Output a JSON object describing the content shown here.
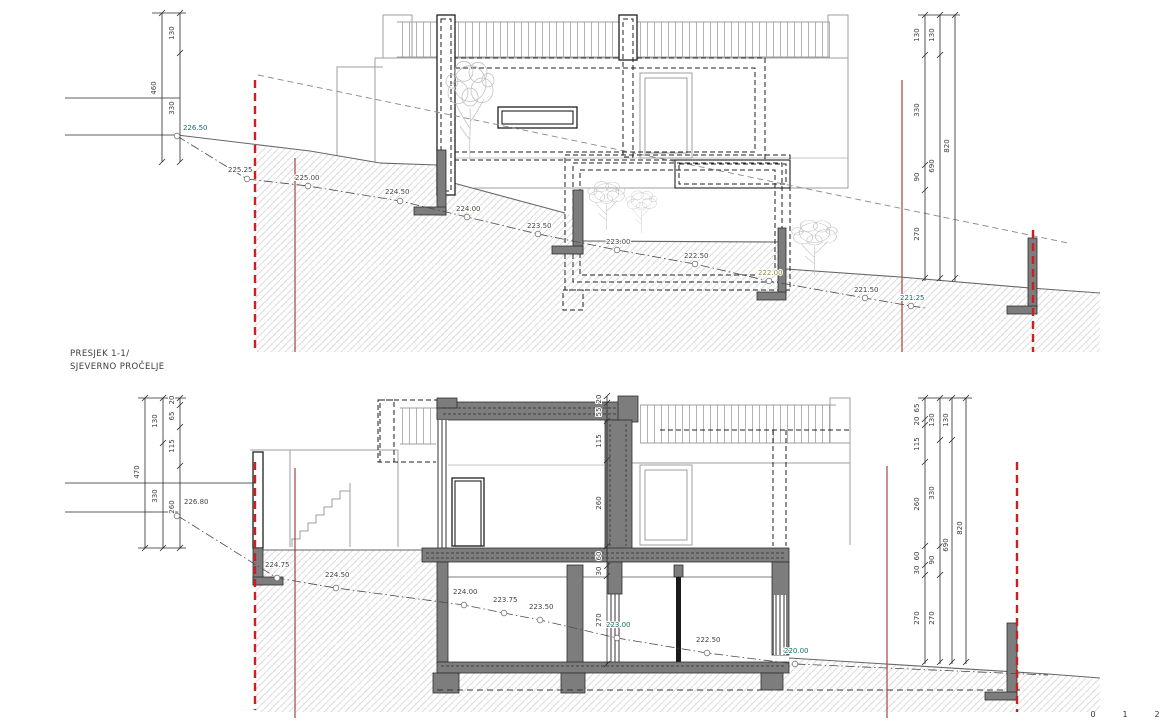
{
  "title": {
    "line1": "PRESJEK 1-1/",
    "line2": "SJEVERNO PROČELJE"
  },
  "scale": {
    "t0": "0",
    "t1": "1",
    "t2": "2"
  },
  "colors": {
    "teal": "#1b6b6b",
    "olive": "#8f8f3a",
    "spot": "#45453f",
    "dim": "#3d3d3a"
  },
  "top": {
    "dims": [
      {
        "t": "460",
        "x": 156,
        "y": 88
      },
      {
        "t": "130",
        "x": 174,
        "y": 33
      },
      {
        "t": "330",
        "x": 174,
        "y": 108
      },
      {
        "t": "130",
        "x": 919,
        "y": 35
      },
      {
        "t": "330",
        "x": 919,
        "y": 110
      },
      {
        "t": "90",
        "x": 919,
        "y": 177
      },
      {
        "t": "270",
        "x": 919,
        "y": 234
      },
      {
        "t": "130",
        "x": 934,
        "y": 35
      },
      {
        "t": "690",
        "x": 934,
        "y": 166
      },
      {
        "t": "820",
        "x": 949,
        "y": 146
      }
    ],
    "spots": [
      {
        "t": "226.50",
        "x": 183,
        "y": 130,
        "cx": 177,
        "cy": 136,
        "c": "teal"
      },
      {
        "t": "225.25",
        "x": 228,
        "y": 172,
        "cx": 247,
        "cy": 179
      },
      {
        "t": "225.00",
        "x": 295,
        "y": 180,
        "cx": 308,
        "cy": 186
      },
      {
        "t": "224.50",
        "x": 385,
        "y": 194,
        "cx": 400,
        "cy": 201
      },
      {
        "t": "224.00",
        "x": 456,
        "y": 211,
        "cx": 467,
        "cy": 217
      },
      {
        "t": "223.50",
        "x": 527,
        "y": 228,
        "cx": 538,
        "cy": 234
      },
      {
        "t": "223.00",
        "x": 606,
        "y": 244,
        "cx": 617,
        "cy": 250
      },
      {
        "t": "222.50",
        "x": 684,
        "y": 258,
        "cx": 695,
        "cy": 264
      },
      {
        "t": "222.00",
        "x": 758,
        "y": 275,
        "cx": 769,
        "cy": 281,
        "c": "olive"
      },
      {
        "t": "221.50",
        "x": 854,
        "y": 292,
        "cx": 865,
        "cy": 298
      },
      {
        "t": "221.25",
        "x": 900,
        "y": 300,
        "cx": 911,
        "cy": 306,
        "c": "teal"
      }
    ]
  },
  "bottom": {
    "dims": [
      {
        "t": "470",
        "x": 139,
        "y": 472
      },
      {
        "t": "130",
        "x": 157,
        "y": 421
      },
      {
        "t": "330",
        "x": 157,
        "y": 496
      },
      {
        "t": "20",
        "x": 174,
        "y": 400
      },
      {
        "t": "65",
        "x": 174,
        "y": 416
      },
      {
        "t": "115",
        "x": 174,
        "y": 446
      },
      {
        "t": "260",
        "x": 174,
        "y": 507
      },
      {
        "t": "20",
        "x": 601,
        "y": 399
      },
      {
        "t": "55",
        "x": 601,
        "y": 412
      },
      {
        "t": "115",
        "x": 601,
        "y": 441
      },
      {
        "t": "260",
        "x": 601,
        "y": 503
      },
      {
        "t": "60",
        "x": 601,
        "y": 556
      },
      {
        "t": "30",
        "x": 601,
        "y": 571
      },
      {
        "t": "270",
        "x": 601,
        "y": 620
      },
      {
        "t": "65",
        "x": 919,
        "y": 408
      },
      {
        "t": "20",
        "x": 919,
        "y": 421
      },
      {
        "t": "115",
        "x": 919,
        "y": 444
      },
      {
        "t": "260",
        "x": 919,
        "y": 504
      },
      {
        "t": "60",
        "x": 919,
        "y": 556
      },
      {
        "t": "30",
        "x": 919,
        "y": 570
      },
      {
        "t": "270",
        "x": 919,
        "y": 618
      },
      {
        "t": "130",
        "x": 934,
        "y": 420
      },
      {
        "t": "330",
        "x": 934,
        "y": 493
      },
      {
        "t": "90",
        "x": 934,
        "y": 560
      },
      {
        "t": "270",
        "x": 934,
        "y": 618
      },
      {
        "t": "130",
        "x": 948,
        "y": 420
      },
      {
        "t": "690",
        "x": 948,
        "y": 545
      },
      {
        "t": "820",
        "x": 962,
        "y": 528
      }
    ],
    "spots": [
      {
        "t": "226.80",
        "x": 184,
        "y": 504,
        "cx": 177,
        "cy": 516
      },
      {
        "t": "224.75",
        "x": 265,
        "y": 567,
        "cx": 277,
        "cy": 578
      },
      {
        "t": "224.50",
        "x": 325,
        "y": 577,
        "cx": 336,
        "cy": 588
      },
      {
        "t": "224.00",
        "x": 453,
        "y": 594,
        "cx": 464,
        "cy": 605
      },
      {
        "t": "223.75",
        "x": 493,
        "y": 602,
        "cx": 504,
        "cy": 613
      },
      {
        "t": "223.50",
        "x": 529,
        "y": 609,
        "cx": 540,
        "cy": 620
      },
      {
        "t": "223.00",
        "x": 606,
        "y": 627,
        "cx": 617,
        "cy": 638,
        "c": "teal"
      },
      {
        "t": "222.50",
        "x": 696,
        "y": 642,
        "cx": 707,
        "cy": 653
      },
      {
        "t": "220.00",
        "x": 784,
        "y": 653,
        "cx": 795,
        "cy": 664,
        "c": "teal"
      }
    ]
  }
}
